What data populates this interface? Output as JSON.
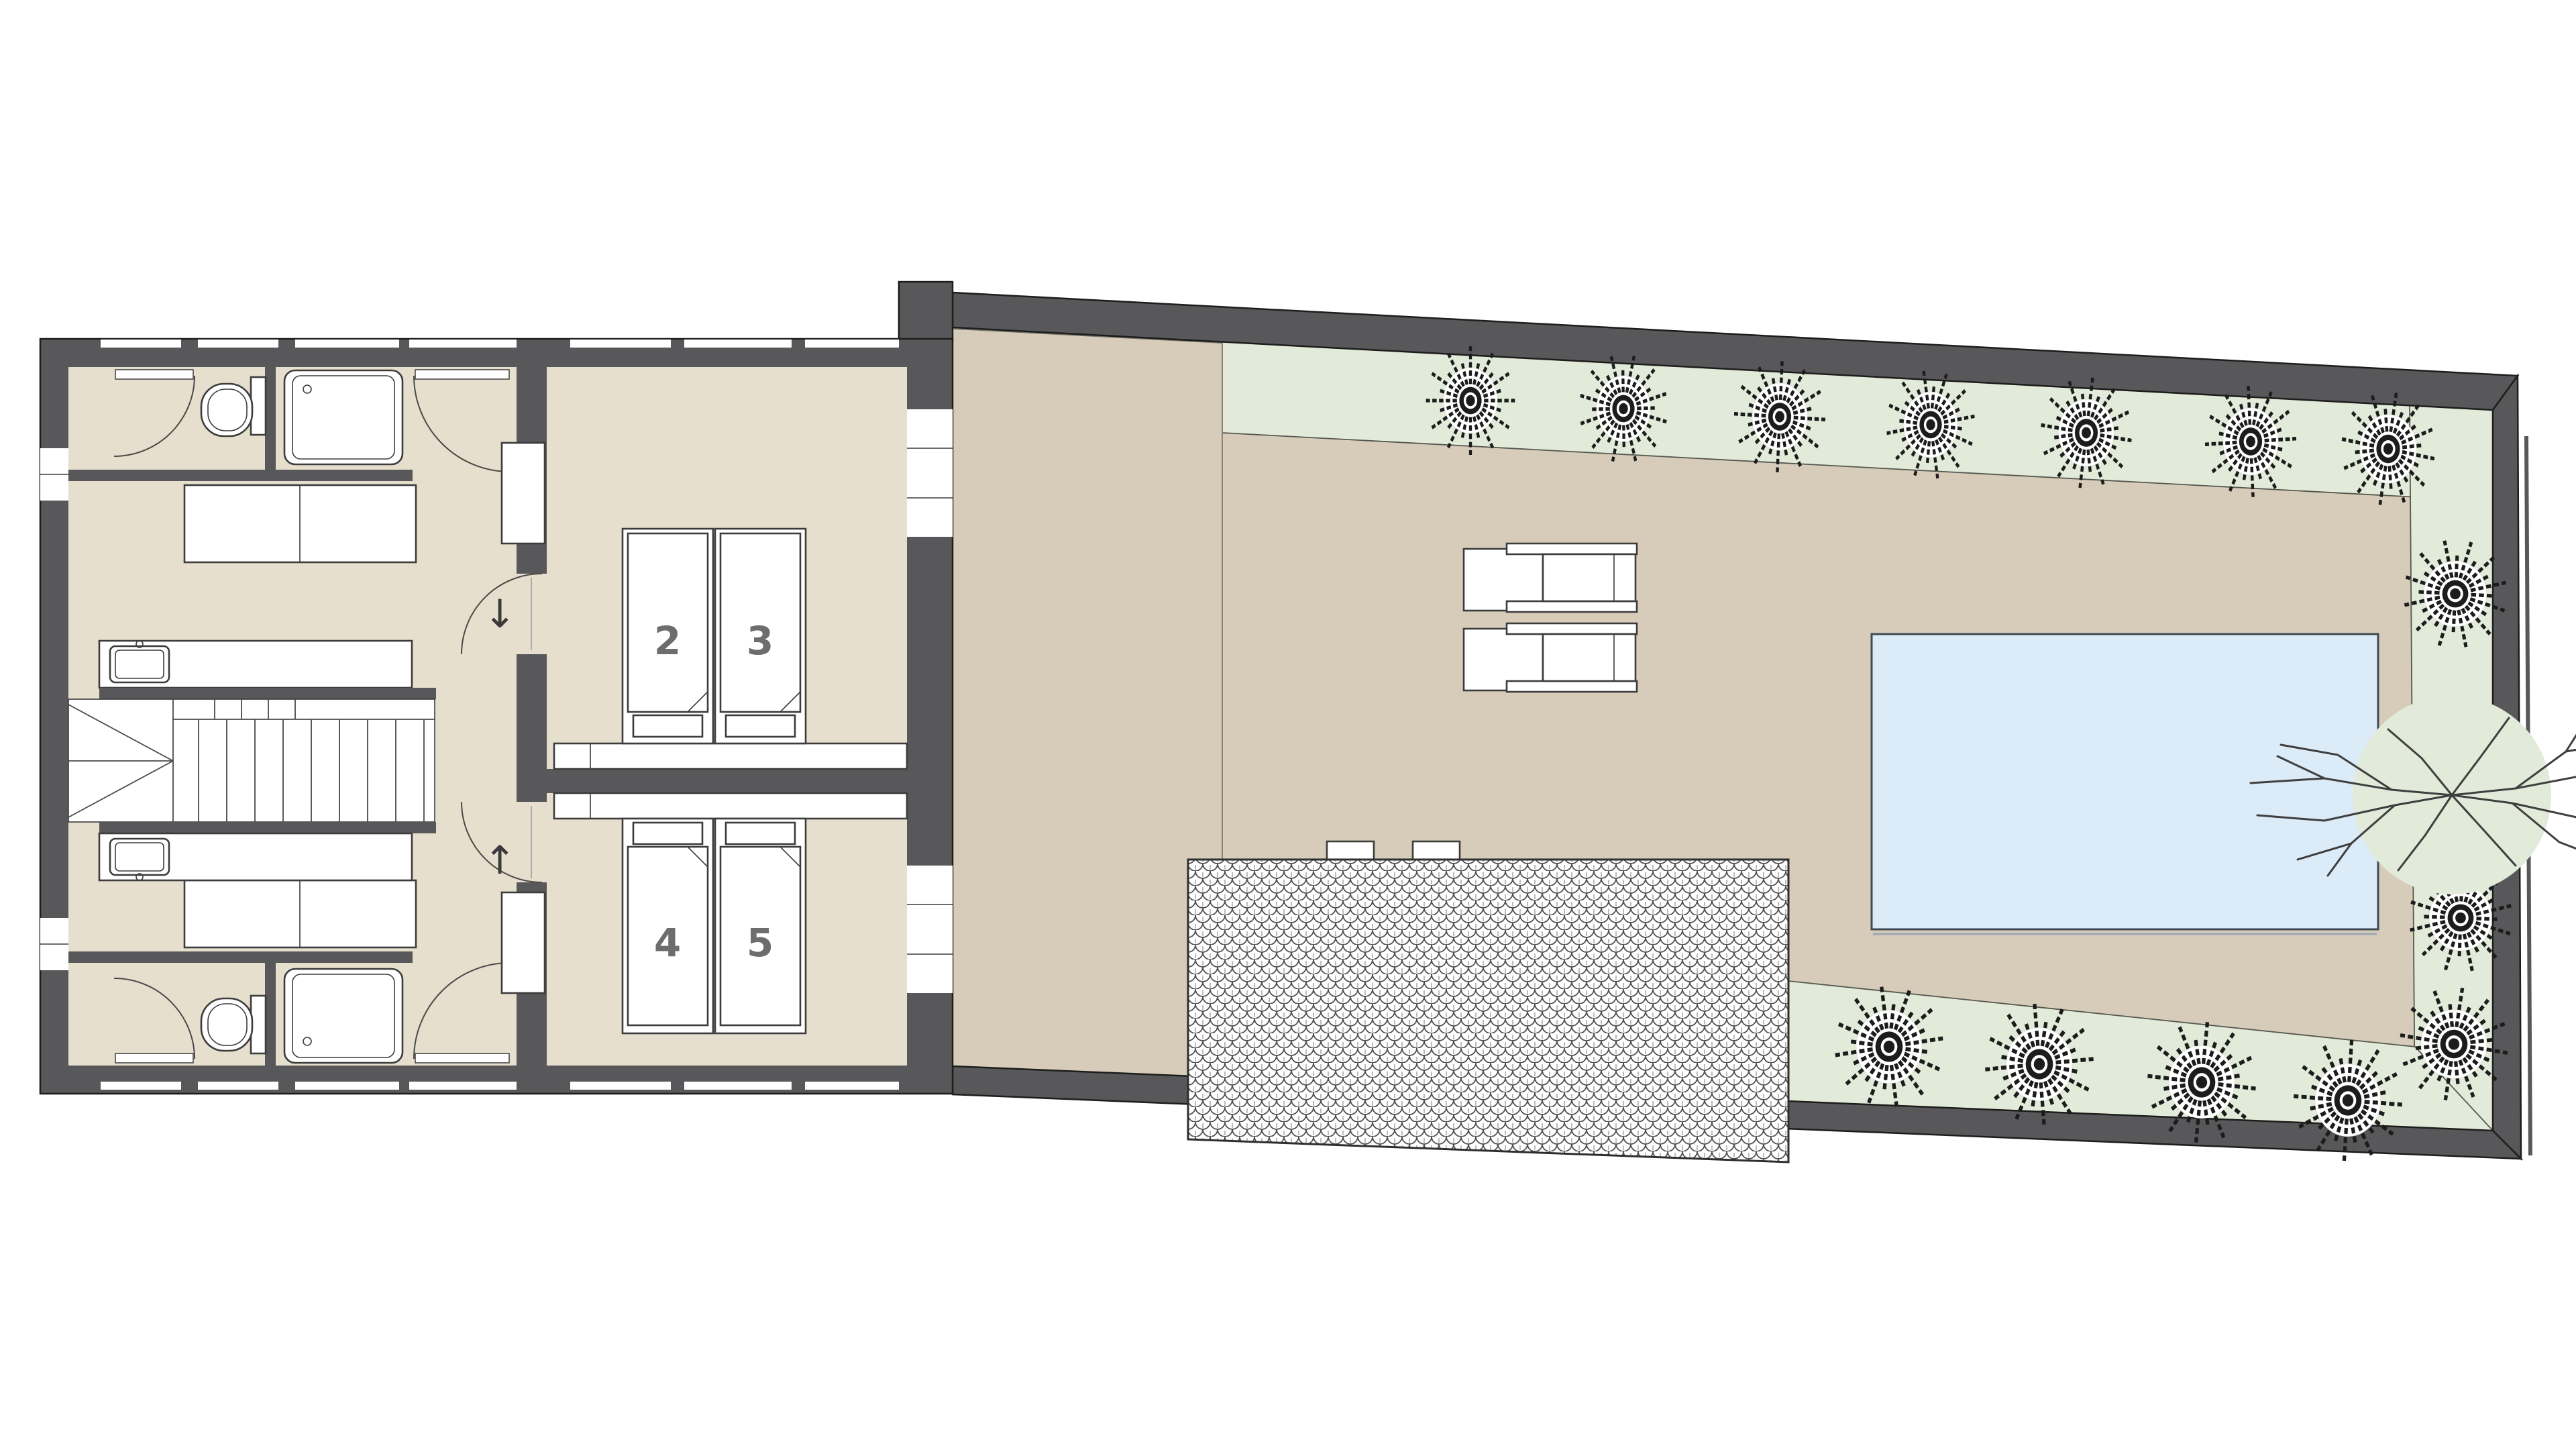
{
  "plan": {
    "beds": [
      {
        "label": "2"
      },
      {
        "label": "3"
      },
      {
        "label": "4"
      },
      {
        "label": "5"
      }
    ],
    "stairs": {
      "down_arrow": "↓",
      "up_arrow": "↑"
    },
    "landscape": {
      "top_row_trees": 7,
      "right_row_trees": 3,
      "bottom_row_trees": 4,
      "bare_tree": 1
    },
    "icons": {
      "shrub": "shrub-tree-icon",
      "bare_tree": "bare-tree-icon",
      "toilet": "toilet-icon",
      "shower": "shower-tray-icon",
      "sink": "sink-icon",
      "bed": "bed-icon",
      "lounger": "sun-lounger-icon",
      "pool": "swimming-pool",
      "roof": "fish-scale-tiled-roof",
      "stairs": "staircase"
    }
  },
  "colors": {
    "wall": "#58585a",
    "outline": "#1d1d1b",
    "floor": "#e7dfcd",
    "terrace": "#d6ccb9",
    "planting": "#e2ead9",
    "pool": "#dcebf8",
    "label": "#6d6d6d",
    "fixture": "#3c3c3c"
  }
}
